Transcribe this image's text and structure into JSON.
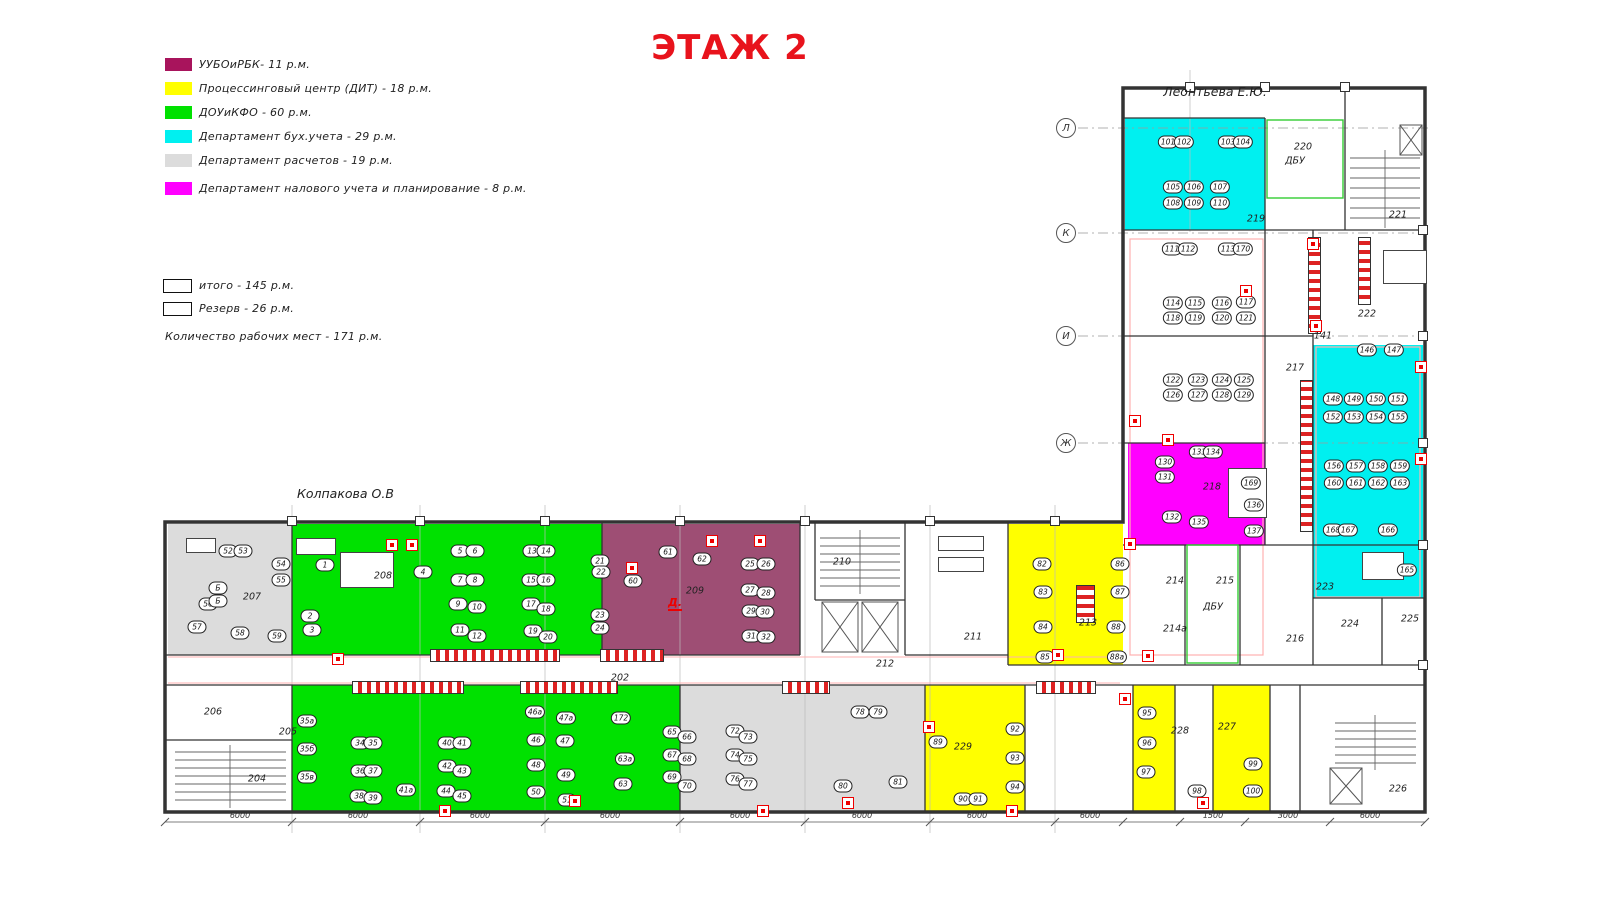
{
  "title": "ЭТАЖ 2",
  "annotations": {
    "owner_top": "Леонтьева Е.Ю.",
    "owner_left": "Колпакова О.В",
    "fire_letter": "Д."
  },
  "legend": {
    "items": [
      {
        "label": "УУБОиРБК- 11 р.м.",
        "color": "#a8145c"
      },
      {
        "label": "Процессинговый центр (ДИТ)  - 18 р.м.",
        "color": "#ffff00"
      },
      {
        "label": "ДОУиКФО - 60 р.м.",
        "color": "#00e100"
      },
      {
        "label": "Департамент бух.учета - 29 р.м.",
        "color": "#00f0f0"
      },
      {
        "label": "Департамент расчетов  - 19 р.м.",
        "color": "#dcdcdc"
      },
      {
        "label": "Департамент налового учета и планирование  - 8 р.м.",
        "color": "#ff00ff"
      }
    ],
    "summary_boxes": [
      {
        "label": "итого - 145 р.м."
      },
      {
        "label": "Резерв - 26 р.м."
      }
    ],
    "total_line": "Количество рабочих мест - 171 р.м."
  },
  "rooms": [
    {
      "id": "207",
      "x": 168,
      "y": 524,
      "w": 124,
      "h": 131,
      "fill": "#dcdcdc"
    },
    {
      "id": "208",
      "x": 292,
      "y": 524,
      "w": 310,
      "h": 131,
      "fill": "#00e100"
    },
    {
      "id": "209",
      "x": 602,
      "y": 524,
      "w": 198,
      "h": 131,
      "fill": "#9e4e74"
    },
    {
      "id": "213",
      "x": 1008,
      "y": 524,
      "w": 115,
      "h": 141,
      "fill": "#ffff00"
    },
    {
      "id": "219",
      "x": 1125,
      "y": 118,
      "w": 140,
      "h": 112,
      "fill": "#00f0f0"
    },
    {
      "id": "218",
      "x": 1128,
      "y": 443,
      "w": 137,
      "h": 102,
      "fill": "#ff00ff"
    },
    {
      "id": "accounting-east",
      "x": 1313,
      "y": 345,
      "w": 110,
      "h": 198,
      "fill": "#00f0f0"
    },
    {
      "id": "223",
      "x": 1313,
      "y": 543,
      "w": 110,
      "h": 55,
      "fill": "#00f0f0"
    },
    {
      "id": "green-south",
      "x": 292,
      "y": 685,
      "w": 388,
      "h": 127,
      "fill": "#00e100"
    },
    {
      "id": "calc-south",
      "x": 680,
      "y": 685,
      "w": 245,
      "h": 127,
      "fill": "#dcdcdc"
    },
    {
      "id": "229",
      "x": 925,
      "y": 685,
      "w": 100,
      "h": 127,
      "fill": "#ffff00"
    },
    {
      "id": "228",
      "x": 1133,
      "y": 685,
      "w": 42,
      "h": 127,
      "fill": "#ffff00"
    },
    {
      "id": "227",
      "x": 1213,
      "y": 685,
      "w": 57,
      "h": 127,
      "fill": "#ffff00"
    }
  ],
  "room_labels": [
    [
      "207",
      252,
      597
    ],
    [
      "208",
      383,
      576
    ],
    [
      "209",
      695,
      591
    ],
    [
      "210",
      842,
      562
    ],
    [
      "211",
      973,
      637
    ],
    [
      "212",
      885,
      664
    ],
    [
      "213",
      1088,
      623
    ],
    [
      "202",
      620,
      678
    ],
    [
      "204",
      257,
      779
    ],
    [
      "205",
      288,
      732
    ],
    [
      "206",
      213,
      712
    ],
    [
      "229",
      963,
      747
    ],
    [
      "228",
      1180,
      731
    ],
    [
      "227",
      1227,
      727
    ],
    [
      "226",
      1398,
      789
    ],
    [
      "219",
      1256,
      219
    ],
    [
      "220",
      1303,
      147
    ],
    [
      "ДБУ",
      1295,
      161
    ],
    [
      "221",
      1398,
      215
    ],
    [
      "222",
      1367,
      314
    ],
    [
      "141",
      1323,
      336
    ],
    [
      "217",
      1295,
      368
    ],
    [
      "218",
      1212,
      487
    ],
    [
      "214",
      1175,
      581
    ],
    [
      "215",
      1225,
      581
    ],
    [
      "ДБУ",
      1213,
      607
    ],
    [
      "214а",
      1175,
      629
    ],
    [
      "216",
      1295,
      639
    ],
    [
      "223",
      1325,
      587
    ],
    [
      "224",
      1350,
      624
    ],
    [
      "225",
      1410,
      619
    ]
  ],
  "desks": [
    [
      "101",
      1168,
      142
    ],
    [
      "102",
      1184,
      142
    ],
    [
      "103",
      1228,
      142
    ],
    [
      "104",
      1243,
      142
    ],
    [
      "105",
      1173,
      187
    ],
    [
      "106",
      1194,
      187
    ],
    [
      "107",
      1220,
      187
    ],
    [
      "108",
      1173,
      203
    ],
    [
      "109",
      1194,
      203
    ],
    [
      "110",
      1220,
      203
    ],
    [
      "111",
      1172,
      249
    ],
    [
      "112",
      1188,
      249
    ],
    [
      "113",
      1228,
      249
    ],
    [
      "170",
      1243,
      249
    ],
    [
      "114",
      1173,
      303
    ],
    [
      "115",
      1195,
      303
    ],
    [
      "116",
      1222,
      303
    ],
    [
      "117",
      1246,
      302
    ],
    [
      "118",
      1173,
      318
    ],
    [
      "119",
      1195,
      318
    ],
    [
      "120",
      1222,
      318
    ],
    [
      "121",
      1246,
      318
    ],
    [
      "122",
      1173,
      380
    ],
    [
      "123",
      1198,
      380
    ],
    [
      "124",
      1222,
      380
    ],
    [
      "125",
      1244,
      380
    ],
    [
      "126",
      1173,
      395
    ],
    [
      "127",
      1198,
      395
    ],
    [
      "128",
      1222,
      395
    ],
    [
      "129",
      1244,
      395
    ],
    [
      "130",
      1165,
      462
    ],
    [
      "131",
      1165,
      477
    ],
    [
      "132",
      1172,
      517
    ],
    [
      "133",
      1199,
      452
    ],
    [
      "134",
      1213,
      452
    ],
    [
      "135",
      1199,
      522
    ],
    [
      "136",
      1254,
      505
    ],
    [
      "137",
      1254,
      531
    ],
    [
      "169",
      1251,
      483
    ],
    [
      "146",
      1367,
      350
    ],
    [
      "147",
      1394,
      350
    ],
    [
      "148",
      1333,
      399
    ],
    [
      "149",
      1354,
      399
    ],
    [
      "150",
      1376,
      399
    ],
    [
      "151",
      1398,
      399
    ],
    [
      "152",
      1333,
      417
    ],
    [
      "153",
      1354,
      417
    ],
    [
      "154",
      1376,
      417
    ],
    [
      "155",
      1398,
      417
    ],
    [
      "156",
      1334,
      466
    ],
    [
      "157",
      1356,
      466
    ],
    [
      "158",
      1378,
      466
    ],
    [
      "159",
      1400,
      466
    ],
    [
      "160",
      1334,
      483
    ],
    [
      "161",
      1356,
      483
    ],
    [
      "162",
      1378,
      483
    ],
    [
      "163",
      1400,
      483
    ],
    [
      "168",
      1333,
      530
    ],
    [
      "167",
      1348,
      530
    ],
    [
      "166",
      1388,
      530
    ],
    [
      "165",
      1407,
      570
    ],
    [
      "52",
      228,
      551
    ],
    [
      "53",
      243,
      551
    ],
    [
      "54",
      281,
      564
    ],
    [
      "55",
      281,
      580
    ],
    [
      "56",
      208,
      604
    ],
    [
      "57",
      197,
      627
    ],
    [
      "58",
      240,
      633
    ],
    [
      "59",
      277,
      636
    ],
    [
      "Б",
      218,
      588
    ],
    [
      "Б",
      218,
      601
    ],
    [
      "1",
      325,
      565
    ],
    [
      "2",
      310,
      616
    ],
    [
      "3",
      312,
      630
    ],
    [
      "4",
      423,
      572
    ],
    [
      "5",
      460,
      551
    ],
    [
      "6",
      475,
      551
    ],
    [
      "7",
      460,
      580
    ],
    [
      "8",
      475,
      580
    ],
    [
      "9",
      458,
      604
    ],
    [
      "10",
      477,
      607
    ],
    [
      "11",
      460,
      630
    ],
    [
      "12",
      477,
      636
    ],
    [
      "13",
      532,
      551
    ],
    [
      "14",
      546,
      551
    ],
    [
      "15",
      531,
      580
    ],
    [
      "16",
      546,
      580
    ],
    [
      "17",
      531,
      604
    ],
    [
      "18",
      546,
      609
    ],
    [
      "19",
      533,
      631
    ],
    [
      "20",
      548,
      637
    ],
    [
      "21",
      600,
      561
    ],
    [
      "22",
      601,
      572
    ],
    [
      "23",
      600,
      615
    ],
    [
      "24",
      600,
      628
    ],
    [
      "60",
      633,
      581
    ],
    [
      "61",
      668,
      552
    ],
    [
      "62",
      702,
      559
    ],
    [
      "25",
      750,
      564
    ],
    [
      "26",
      766,
      564
    ],
    [
      "27",
      750,
      590
    ],
    [
      "28",
      766,
      593
    ],
    [
      "29",
      751,
      611
    ],
    [
      "30",
      765,
      612
    ],
    [
      "31",
      751,
      636
    ],
    [
      "32",
      766,
      637
    ],
    [
      "82",
      1042,
      564
    ],
    [
      "83",
      1043,
      592
    ],
    [
      "84",
      1043,
      627
    ],
    [
      "85",
      1045,
      657
    ],
    [
      "86",
      1120,
      564
    ],
    [
      "87",
      1120,
      592
    ],
    [
      "88",
      1116,
      627
    ],
    [
      "88а",
      1117,
      657
    ],
    [
      "35а",
      307,
      721
    ],
    [
      "35б",
      307,
      749
    ],
    [
      "35в",
      307,
      777
    ],
    [
      "34",
      360,
      743
    ],
    [
      "35",
      373,
      743
    ],
    [
      "36",
      360,
      771
    ],
    [
      "37",
      373,
      771
    ],
    [
      "38",
      359,
      796
    ],
    [
      "39",
      373,
      798
    ],
    [
      "40",
      447,
      743
    ],
    [
      "41",
      462,
      743
    ],
    [
      "42",
      447,
      766
    ],
    [
      "43",
      462,
      771
    ],
    [
      "44",
      446,
      791
    ],
    [
      "45",
      462,
      796
    ],
    [
      "41а",
      406,
      790
    ],
    [
      "46а",
      535,
      712
    ],
    [
      "47а",
      566,
      718
    ],
    [
      "46",
      536,
      740
    ],
    [
      "47",
      565,
      741
    ],
    [
      "48",
      536,
      765
    ],
    [
      "49",
      566,
      775
    ],
    [
      "50",
      536,
      792
    ],
    [
      "51",
      567,
      800
    ],
    [
      "172",
      621,
      718
    ],
    [
      "63а",
      625,
      759
    ],
    [
      "63",
      623,
      784
    ],
    [
      "65",
      672,
      732
    ],
    [
      "66",
      687,
      737
    ],
    [
      "67",
      672,
      755
    ],
    [
      "68",
      687,
      759
    ],
    [
      "69",
      672,
      777
    ],
    [
      "70",
      687,
      786
    ],
    [
      "72",
      735,
      731
    ],
    [
      "73",
      748,
      737
    ],
    [
      "74",
      735,
      755
    ],
    [
      "75",
      748,
      759
    ],
    [
      "76",
      735,
      779
    ],
    [
      "77",
      748,
      784
    ],
    [
      "78",
      860,
      712
    ],
    [
      "79",
      878,
      712
    ],
    [
      "80",
      843,
      786
    ],
    [
      "81",
      898,
      782
    ],
    [
      "89",
      938,
      742
    ],
    [
      "90",
      963,
      799
    ],
    [
      "91",
      978,
      799
    ],
    [
      "92",
      1015,
      729
    ],
    [
      "93",
      1015,
      758
    ],
    [
      "94",
      1015,
      787
    ],
    [
      "95",
      1147,
      713
    ],
    [
      "96",
      1147,
      743
    ],
    [
      "97",
      1146,
      772
    ],
    [
      "98",
      1197,
      791
    ],
    [
      "99",
      1253,
      764
    ],
    [
      "100",
      1253,
      791
    ]
  ],
  "markers": [
    [
      392,
      545
    ],
    [
      412,
      545
    ],
    [
      632,
      568
    ],
    [
      712,
      541
    ],
    [
      760,
      541
    ],
    [
      338,
      659
    ],
    [
      445,
      811
    ],
    [
      575,
      801
    ],
    [
      763,
      811
    ],
    [
      848,
      803
    ],
    [
      1012,
      811
    ],
    [
      929,
      727
    ],
    [
      1125,
      699
    ],
    [
      1203,
      803
    ],
    [
      1246,
      291
    ],
    [
      1135,
      421
    ],
    [
      1130,
      544
    ],
    [
      1313,
      244
    ],
    [
      1316,
      326
    ],
    [
      1421,
      367
    ],
    [
      1421,
      459
    ],
    [
      1168,
      440
    ],
    [
      1148,
      656
    ],
    [
      1058,
      655
    ]
  ],
  "cabinets": [
    [
      430,
      649,
      128,
      11
    ],
    [
      600,
      649,
      62,
      11
    ],
    [
      352,
      681,
      110,
      11
    ],
    [
      520,
      681,
      96,
      11
    ],
    [
      782,
      681,
      46,
      11
    ],
    [
      1036,
      681,
      58,
      11
    ],
    [
      1308,
      237,
      11,
      95
    ],
    [
      1358,
      237,
      11,
      66
    ],
    [
      1300,
      380,
      11,
      150
    ],
    [
      1076,
      585,
      17,
      36
    ]
  ],
  "furniture": [
    [
      340,
      552,
      52,
      34
    ],
    [
      296,
      538,
      38,
      15
    ],
    [
      1383,
      250,
      42,
      32
    ],
    [
      1362,
      552,
      40,
      26
    ],
    [
      938,
      536,
      44,
      13
    ],
    [
      938,
      557,
      44,
      13
    ],
    [
      186,
      538,
      28,
      13
    ],
    [
      1228,
      468,
      37,
      48
    ]
  ],
  "axes": [
    [
      "Л",
      1066,
      128
    ],
    [
      "К",
      1066,
      233
    ],
    [
      "И",
      1066,
      336
    ],
    [
      "Ж",
      1066,
      443
    ]
  ],
  "dimensions": [
    [
      "6000",
      240
    ],
    [
      "6000",
      358
    ],
    [
      "6000",
      480
    ],
    [
      "6000",
      610
    ],
    [
      "6000",
      740
    ],
    [
      "6000",
      862
    ],
    [
      "6000",
      977
    ],
    [
      "6000",
      1090
    ],
    [
      "1500",
      1213
    ],
    [
      "3000",
      1288
    ],
    [
      "6000",
      1370
    ]
  ],
  "column_ticks": [
    [
      292,
      521
    ],
    [
      420,
      521
    ],
    [
      545,
      521
    ],
    [
      680,
      521
    ],
    [
      805,
      521
    ],
    [
      930,
      521
    ],
    [
      1055,
      521
    ],
    [
      1190,
      87
    ],
    [
      1265,
      87
    ],
    [
      1345,
      87
    ],
    [
      1423,
      230
    ],
    [
      1423,
      336
    ],
    [
      1423,
      443
    ],
    [
      1423,
      545
    ],
    [
      1423,
      665
    ]
  ]
}
